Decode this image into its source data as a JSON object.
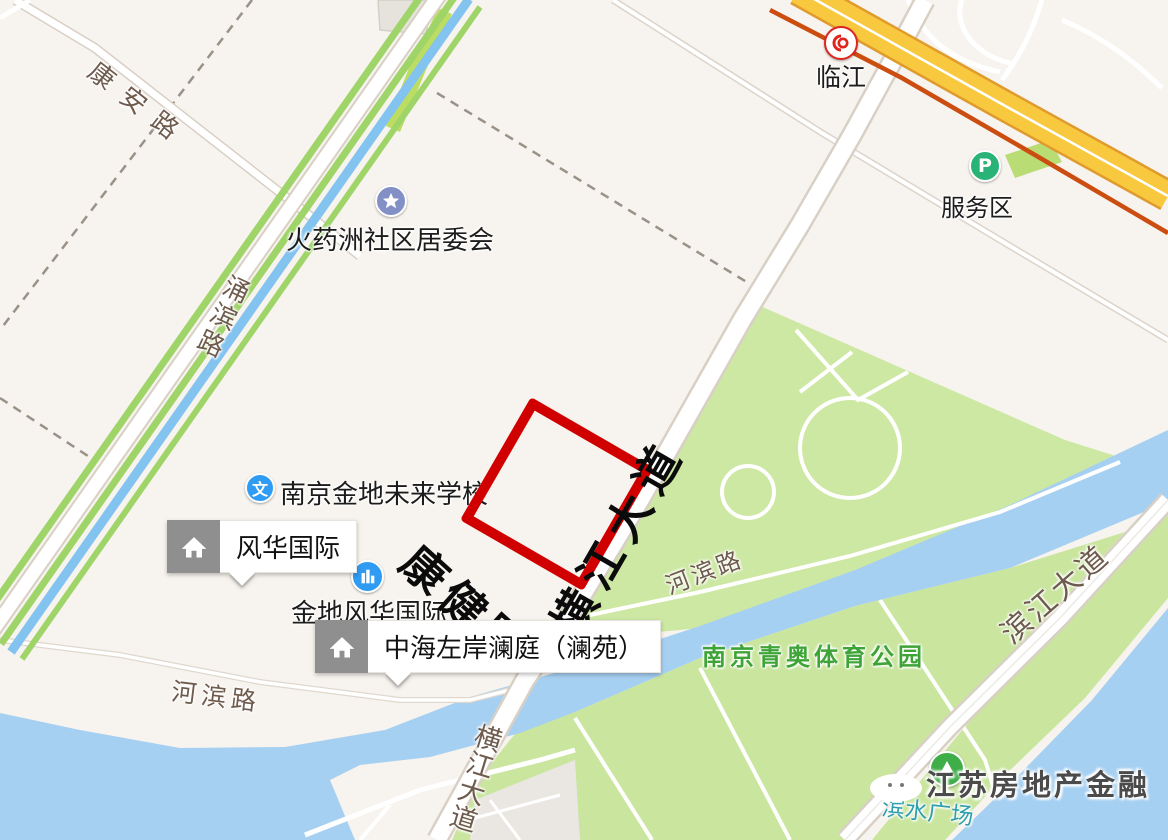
{
  "map": {
    "colors": {
      "land": "#f7f3ee",
      "water": "#a6d0f2",
      "canal": "#82c3ef",
      "park": "#cde8a3",
      "greenway_stripe": "#9fd468",
      "road_fill": "#ffffff",
      "road_casing": "#d9d0c5",
      "highway_fill": "#f8c93e",
      "highway_casing": "#e09b2d",
      "rail_line": "#cb4e10",
      "plot_outline": "#d10000"
    },
    "station": {
      "name": "临江"
    },
    "service_area": {
      "label": "服务区",
      "icon_letter": "P"
    },
    "pois": {
      "committee": {
        "label": "火药洲社区居委会"
      },
      "school": {
        "label": "南京金地未来学校",
        "icon_char": "文"
      },
      "jindi": {
        "label": "金地风华国际"
      },
      "fenghua_bubble": {
        "label": "风华国际"
      },
      "zhonghai_bubble": {
        "label": "中海左岸澜庭（澜苑）"
      },
      "qingao_park": {
        "label": "南京青奥体育公园"
      },
      "binshui_plaza": {
        "label": "滨水广场"
      }
    },
    "roads": {
      "kang_an": "康安路",
      "yong_bin": "涌滨路",
      "kang_jian": "康健路",
      "heng_jiang_main": "横江大道",
      "heng_jiang_south": "横江大道",
      "he_bin_east": "河滨路",
      "he_bin_west": "河滨路",
      "bin_jiang": "滨江大道"
    },
    "watermark": "江苏房地产金融"
  }
}
